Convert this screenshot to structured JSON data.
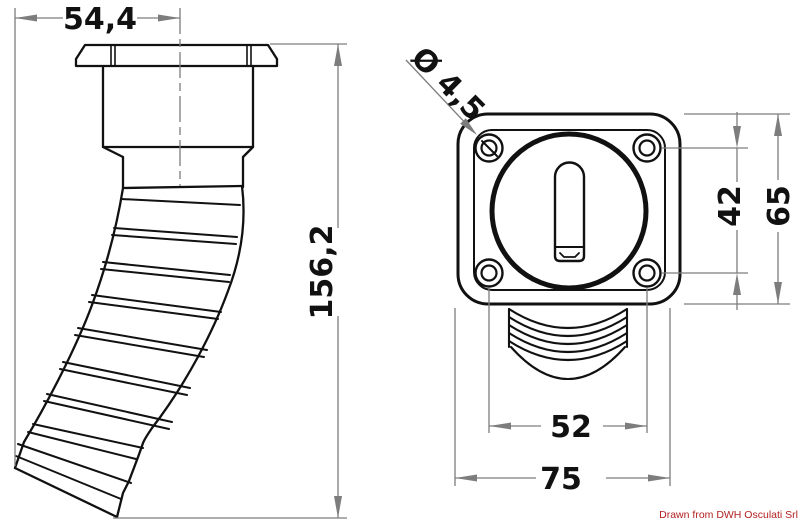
{
  "drawing": {
    "credit": "Drawn from DWH Osculati Srl",
    "colors": {
      "outline": "#111111",
      "dimension_line": "#7d7d7d",
      "dimension_text": "#111111",
      "credit_text": "#b22020",
      "background": "#ffffff"
    },
    "dimensions": {
      "top_width": "54,4",
      "total_height": "156,2",
      "hole_diameter": "Ø 4,5",
      "hole_spacing_vertical": "42",
      "flange_height": "65",
      "hole_spacing_horizontal": "52",
      "flange_width": "75"
    }
  }
}
